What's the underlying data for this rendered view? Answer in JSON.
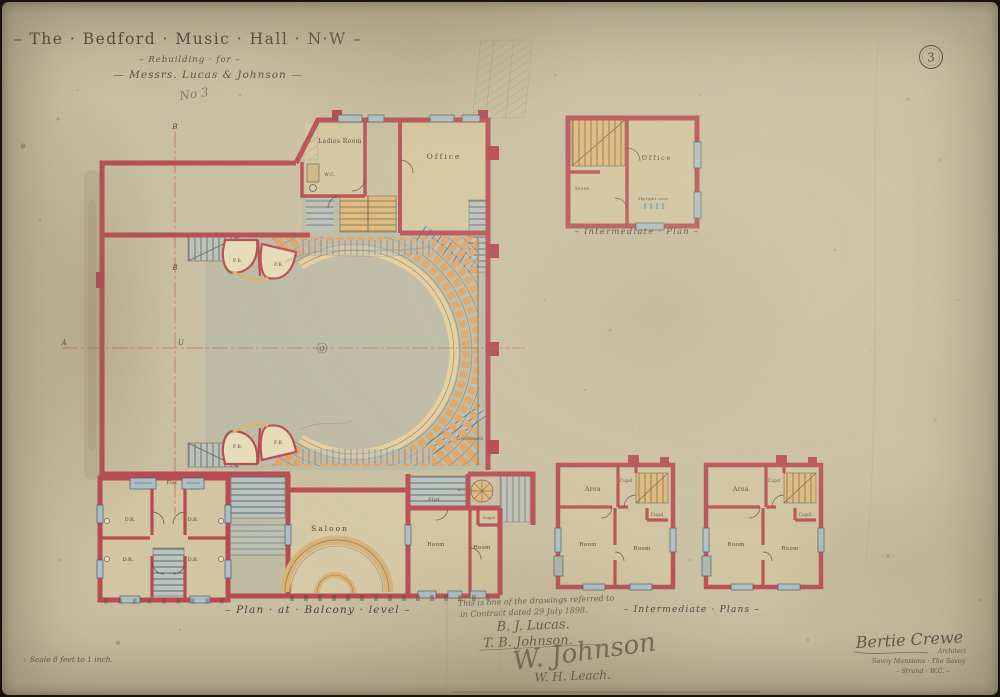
{
  "page": {
    "sheet_number": "3",
    "pencil_mark": "No 3"
  },
  "title": {
    "line1": "– The · Bedford · Music · Hall · N·W –",
    "line2": "– Rebuilding · for –",
    "line3": "— Messrs. Lucas & Johnson —"
  },
  "main_plan": {
    "caption": "– Plan · at · Balcony · level –",
    "labels": {
      "ladies_room": "Ladies Room",
      "wc": "W.C.",
      "office": "Office",
      "saloon": "Saloon",
      "flat_roof": "Flat",
      "flat_small": "Flat",
      "room_left": "Room",
      "room_right": "Room",
      "cupboard": "Cupd",
      "gentlemen": "Gentlemen",
      "wc_small": "w.c.",
      "dressing_room": "D.R.",
      "private_box": "P.B."
    },
    "section_markers": {
      "a": "A",
      "b": "B",
      "o": "O",
      "u": "U"
    }
  },
  "intermediate_plan_top": {
    "caption": "– Intermediate · Plan –",
    "labels": {
      "office": "Office",
      "store": "Store",
      "skylight": "Skylight over"
    }
  },
  "intermediate_plans_bottom": {
    "caption": "– Intermediate · Plans –",
    "labels": {
      "area": "Area",
      "cupboard_top": "Cupd",
      "cupboard_mid": "Cupd",
      "room_left": "Room",
      "room_right": "Room"
    }
  },
  "contract_note": {
    "line1": "This is one of the drawings referred to",
    "line2": "in Contract dated 29 July 1898.",
    "signature1": "B. J. Lucas.",
    "signature2": "T. B. Johnson.",
    "signature3": "W. Johnson",
    "signature4": "W. H. Leach."
  },
  "architect": {
    "name": "Bertie Crewe",
    "title": "Architect",
    "address_line1": "Savoy Mansions · The Savoy",
    "address_line2": "– Strand · W.C. –"
  },
  "scale_note": "Scale 8 feet to 1 inch.",
  "colors": {
    "paper": "#c9bfa2",
    "wall_red": "#b84a52",
    "floor_green": "#b2b8a8",
    "seat_tan": "#dfa468",
    "balcony_cream": "#e6cf9e",
    "stair_grey": "#b9c3c0",
    "stair_buff": "#ddba7e",
    "window_blue": "#adc0c8",
    "ink": "#4a4238",
    "centerline_red": "#c4504f"
  }
}
